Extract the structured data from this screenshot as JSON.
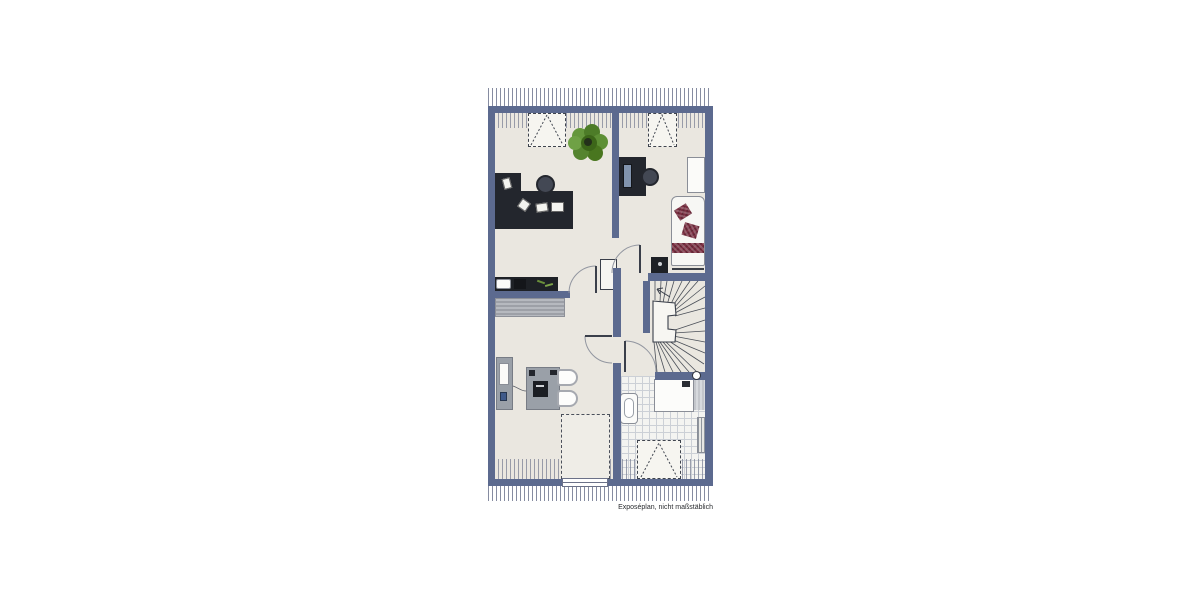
{
  "meta": {
    "type": "floor-plan",
    "caption": "Exposéplan, nicht maßstäblich"
  },
  "colors": {
    "wall": "#5c6a8f",
    "floor": "#eae7e0",
    "furniture_dark": "#23262d",
    "furniture_gray": "#9aa0a8",
    "accent_maroon": "#7c2f42",
    "plant_green": "#4d7c28",
    "tile_line": "#ccd0d6",
    "hatch_line": "#868ca1",
    "background": "#ffffff"
  },
  "rooms": [
    {
      "name": "office",
      "position": "top-left"
    },
    {
      "name": "bedroom",
      "position": "top-right"
    },
    {
      "name": "living-room",
      "position": "bottom-left"
    },
    {
      "name": "bathroom",
      "position": "bottom-right"
    },
    {
      "name": "hallway",
      "position": "center"
    },
    {
      "name": "staircase",
      "position": "right-middle"
    }
  ],
  "symbols": [
    "roof-hatching",
    "skylight-dashed",
    "door-swing-arc",
    "winder-stair",
    "corner-desk",
    "office-chair",
    "plant",
    "kitchenette-counter",
    "rug",
    "pc-desk",
    "wardrobe",
    "single-bed",
    "nightstand",
    "sideboard",
    "table-with-laptop",
    "chairs",
    "shower",
    "washbasin",
    "radiator",
    "floor-void-dashed",
    "window",
    "column"
  ]
}
